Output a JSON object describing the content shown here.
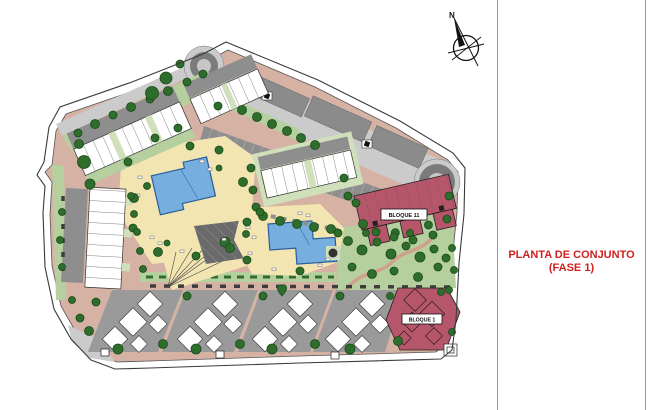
{
  "title_block": {
    "line1": "PLANTA DE CONJUNTO",
    "line2": "(FASE 1)"
  },
  "compass": {
    "north_label": "N"
  },
  "plan": {
    "labels": {
      "bloque_11": "BLOQUE 11",
      "bloque_1": "BLOQUE 1"
    }
  },
  "colors": {
    "road": "#d6b2a4",
    "green_light": "#b5d09e",
    "green_pad": "#cfe0bb",
    "green_dark": "#2f6d2c",
    "tree_edge": "#184a18",
    "parking_dark": "#8e8e8e",
    "paving_light": "#cbcbcb",
    "building_gray": "#8b8b8b",
    "pool_deck": "#f3e5b2",
    "pool_water": "#76aedd",
    "pool_edge": "#2a5d9e",
    "block_red": "#b5566b",
    "title_red": "#d02020",
    "boundary": "#3a3a3a"
  }
}
